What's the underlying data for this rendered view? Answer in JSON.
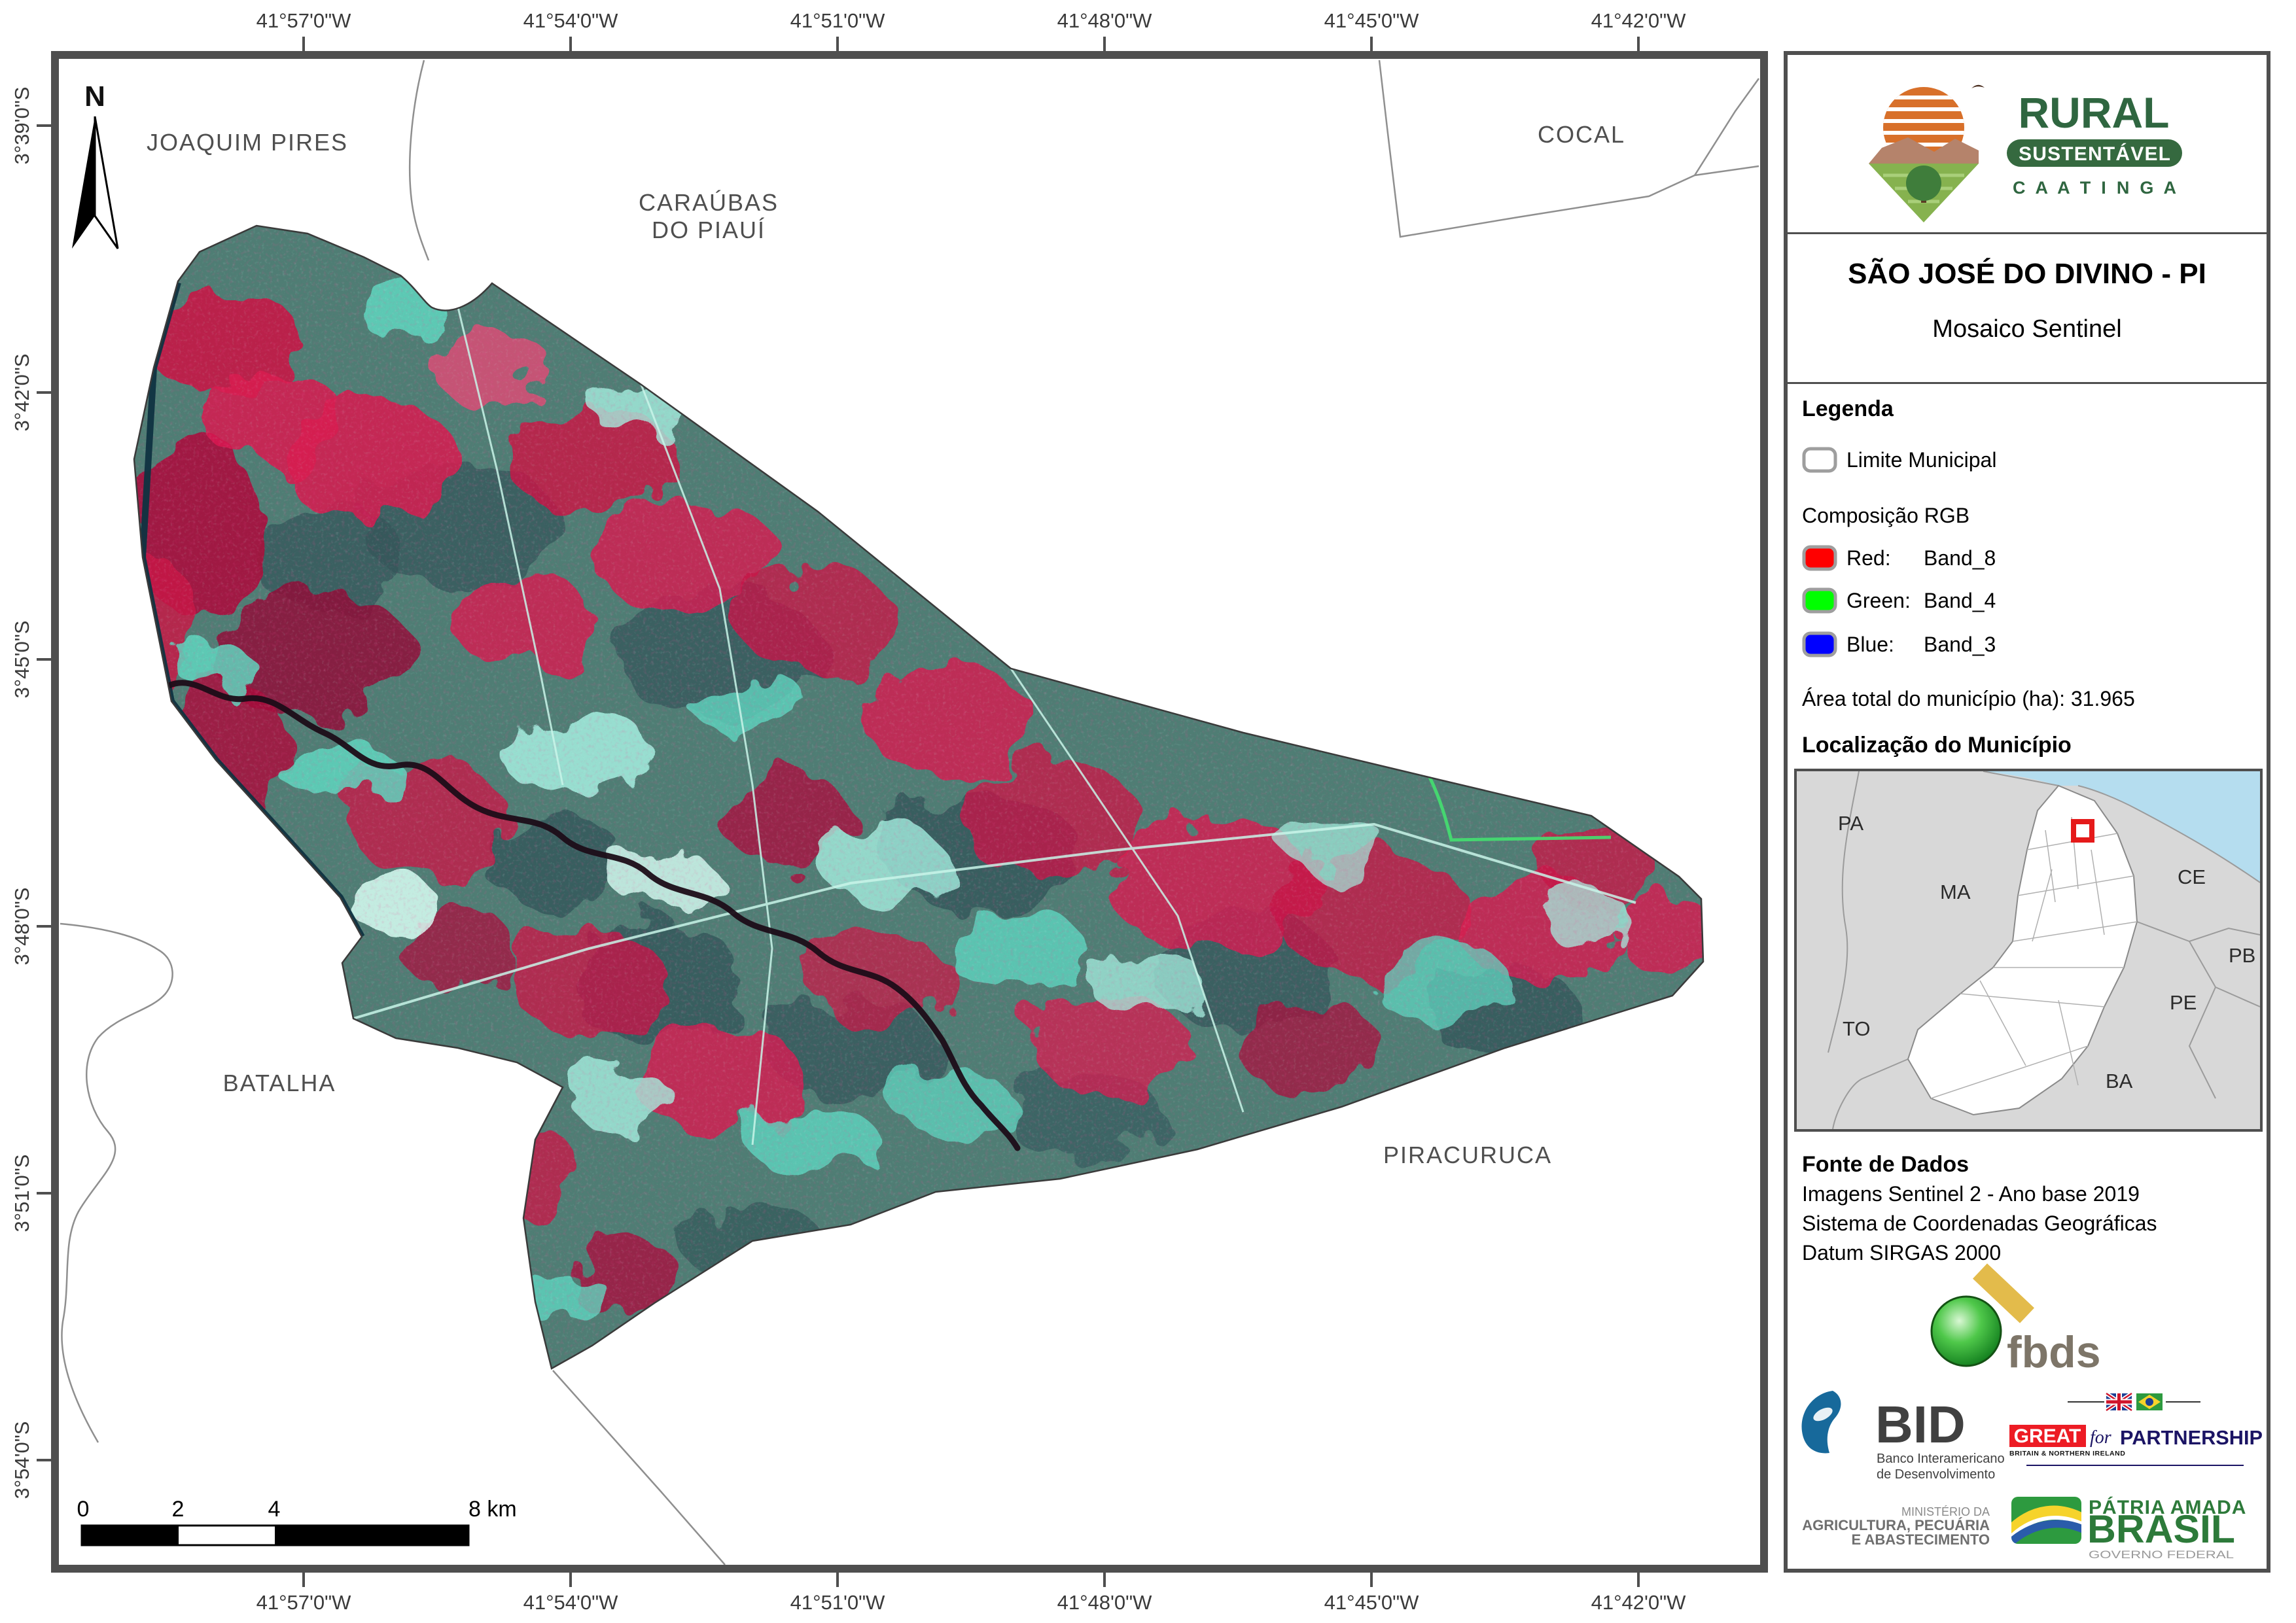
{
  "map": {
    "north": "N",
    "lon_labels": [
      "41°57'0\"W",
      "41°54'0\"W",
      "41°51'0\"W",
      "41°48'0\"W",
      "41°45'0\"W",
      "41°42'0\"W"
    ],
    "lat_labels": [
      "3°39'0\"S",
      "3°42'0\"S",
      "3°45'0\"S",
      "3°48'0\"S",
      "3°51'0\"S",
      "3°54'0\"S"
    ],
    "places": {
      "joaquim_pires": "JOAQUIM PIRES",
      "caraubas_1": "CARAÚBAS",
      "caraubas_2": "DO PIAUÍ",
      "cocal": "COCAL",
      "batalha": "BATALHA",
      "piracuruca": "PIRACURUCA"
    },
    "scalebar": {
      "t0": "0",
      "t2": "2",
      "t4": "4",
      "t8": "8 km"
    }
  },
  "sidebar": {
    "program": {
      "line1": "RURAL",
      "line2": "SUSTENTÁVEL",
      "line3": "C A A T I N G A"
    },
    "title": "SÃO JOSÉ DO DIVINO - PI",
    "subtitle": "Mosaico Sentinel",
    "legend": {
      "heading": "Legenda",
      "limite_label": "Limite Municipal",
      "limite_color": "#ffffff",
      "rgb_heading": "Composição RGB",
      "items": [
        {
          "label": "Red:",
          "value": "Band_8",
          "color": "#ff0000"
        },
        {
          "label": "Green:",
          "value": "Band_4",
          "color": "#00ff00"
        },
        {
          "label": "Blue:",
          "value": "Band_3",
          "color": "#0000ff"
        }
      ],
      "area_text": "Área total do município (ha): 31.965"
    },
    "location": {
      "heading": "Localização do Município",
      "states": [
        "PA",
        "MA",
        "CE",
        "PB",
        "PE",
        "TO",
        "BA"
      ]
    },
    "fonte": {
      "heading": "Fonte de Dados",
      "line1": "Imagens Sentinel 2 - Ano base 2019",
      "line2": "Sistema de Coordenadas Geográficas",
      "line3": "Datum SIRGAS 2000"
    },
    "logos": {
      "fbds": "fbds",
      "bid": "BID",
      "bid_sub1": "Banco Interamericano",
      "bid_sub2": "de Desenvolvimento",
      "great": "GREAT",
      "great_sub": "BRITAIN & NORTHERN IRELAND",
      "for_word": "for",
      "partnership": "PARTNERSHIP",
      "ministry1": "MINISTÉRIO DA",
      "ministry2": "AGRICULTURA, PECUÁRIA",
      "ministry3": "E ABASTECIMENTO",
      "patria": "PÁTRIA AMADA",
      "brasil": "BRASIL",
      "governo": "GOVERNO FEDERAL"
    }
  },
  "colors": {
    "frame": "#4f4f4f",
    "imagery_red": "#d81b50",
    "imagery_teal": "#4f7d74",
    "imagery_cyan": "#63d8c4",
    "water": "#b5ddef",
    "marker_red": "#e51a1a"
  }
}
